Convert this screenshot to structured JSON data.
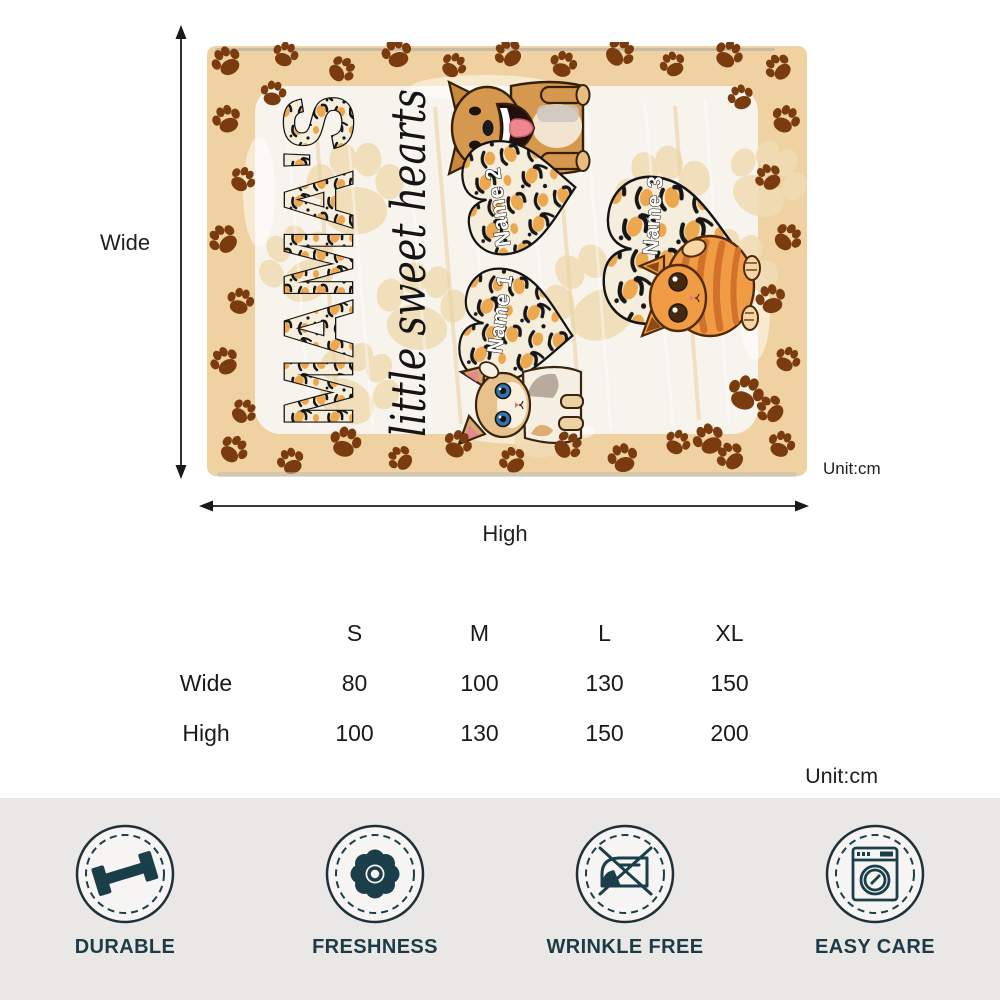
{
  "blanket": {
    "title": "MAMA'S",
    "subtitle": "little sweet hearts",
    "names": [
      "Name 1",
      "Name 2",
      "Name 3"
    ]
  },
  "dimensions": {
    "vertical_label": "Wide",
    "horizontal_label": "High",
    "unit_label": "Unit:cm"
  },
  "size_table": {
    "columns": [
      "S",
      "M",
      "L",
      "XL"
    ],
    "rows": [
      {
        "label": "Wide",
        "values": [
          "80",
          "100",
          "130",
          "150"
        ]
      },
      {
        "label": "High",
        "values": [
          "100",
          "130",
          "150",
          "200"
        ]
      }
    ],
    "unit_label": "Unit:cm"
  },
  "features": [
    {
      "icon": "dumbbell-icon",
      "label": "DURABLE"
    },
    {
      "icon": "flower-icon",
      "label": "FRESHNESS"
    },
    {
      "icon": "no-iron-icon",
      "label": "WRINKLE FREE"
    },
    {
      "icon": "washing-machine-icon",
      "label": "EASY CARE"
    }
  ],
  "colors": {
    "accent_teal": "#1c3b47",
    "blanket_tan": "#f0d2a2",
    "paw_brown": "#7a3c0f",
    "leopard_orange": "#eda74e",
    "bar_background": "#e9e8e6"
  }
}
